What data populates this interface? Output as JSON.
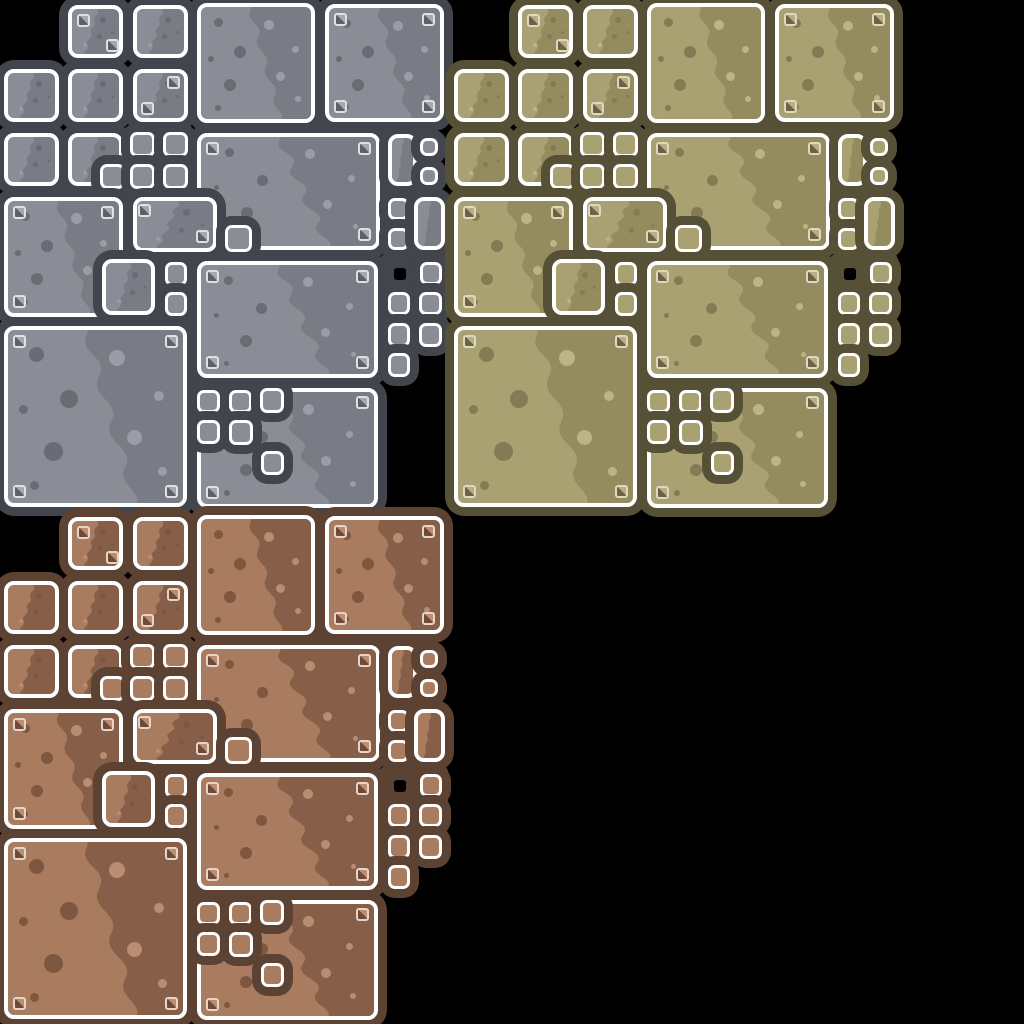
{
  "canvas": {
    "width": 1024,
    "height": 1024,
    "background": "#000000"
  },
  "sheet": {
    "description": "stone panel spritesheet, three color themes, identical tile layout per theme",
    "groups": [
      {
        "id": "gray",
        "label": "gray-stone-panels",
        "offset": {
          "x": 0,
          "y": 0
        },
        "colors": {
          "backing": "#43454d",
          "base": "#8b8d96",
          "shade": "#7a7c85",
          "dot_dark": "#6a6c75",
          "dot_light": "#9a9da6",
          "border": "#ffffff",
          "rivet_border": "#dfe0e3",
          "rivet_dark": "#5e6068",
          "rivet_light": "#a5a8b0"
        }
      },
      {
        "id": "olive",
        "label": "olive-stone-panels",
        "offset": {
          "x": 450,
          "y": 0
        },
        "colors": {
          "backing": "#565136",
          "base": "#aaa173",
          "shade": "#948b5e",
          "dot_dark": "#847b54",
          "dot_light": "#bcb388",
          "border": "#ffffff",
          "rivet_border": "#ded8c3",
          "rivet_dark": "#6c6343",
          "rivet_light": "#b7ae85"
        }
      },
      {
        "id": "brown",
        "label": "brown-stone-panels",
        "offset": {
          "x": 0,
          "y": 512
        },
        "colors": {
          "backing": "#5c4233",
          "base": "#a97b5f",
          "shade": "#875f49",
          "dot_dark": "#7d573f",
          "dot_light": "#b98d70",
          "border": "#ffffff",
          "rivet_border": "#e3d5ca",
          "rivet_dark": "#6f4a37",
          "rivet_light": "#bb8e71"
        }
      }
    ],
    "ring_width": 9,
    "blob_path": "M103,-3 L103,103 L72,103 C80,94 61,90 67,79 C73,68 53,65 59,53 C65,41 46,39 52,27 C58,15 40,14 45,3 C46,0 45,-2 44,-3 Z",
    "dots_large": [
      {
        "x": 0.16,
        "y": 0.14,
        "s": 0.085,
        "tone": "dark"
      },
      {
        "x": 0.35,
        "y": 0.4,
        "s": 0.105,
        "tone": "dark"
      },
      {
        "x": 0.09,
        "y": 0.46,
        "s": 0.05,
        "tone": "dark"
      },
      {
        "x": 0.26,
        "y": 0.7,
        "s": 0.11,
        "tone": "dark"
      },
      {
        "x": 0.15,
        "y": 0.9,
        "s": 0.05,
        "tone": "dark"
      },
      {
        "x": 0.62,
        "y": 0.16,
        "s": 0.095,
        "tone": "light"
      },
      {
        "x": 0.86,
        "y": 0.38,
        "s": 0.06,
        "tone": "light"
      },
      {
        "x": 0.72,
        "y": 0.62,
        "s": 0.085,
        "tone": "light"
      },
      {
        "x": 0.88,
        "y": 0.82,
        "s": 0.05,
        "tone": "light"
      }
    ],
    "dots_small": [
      {
        "x": 0.35,
        "y": 0.24,
        "s": 0.14,
        "tone": "dark"
      },
      {
        "x": 0.14,
        "y": 0.52,
        "s": 0.07,
        "tone": "dark"
      },
      {
        "x": 0.42,
        "y": 0.62,
        "s": 0.11,
        "tone": "dark"
      },
      {
        "x": 0.72,
        "y": 0.8,
        "s": 0.08,
        "tone": "light"
      }
    ],
    "tiles": [
      {
        "t": "p",
        "x": 68,
        "y": 5,
        "w": 55,
        "h": 53,
        "riv": [
          [
            9,
            9
          ],
          [
            38,
            34
          ]
        ]
      },
      {
        "t": "p",
        "x": 133,
        "y": 5,
        "w": 55,
        "h": 53
      },
      {
        "t": "p",
        "x": 197,
        "y": 3,
        "w": 118,
        "h": 120
      },
      {
        "t": "p",
        "x": 325,
        "y": 4,
        "w": 119,
        "h": 118,
        "riv": [
          [
            9,
            9
          ],
          [
            97,
            9
          ],
          [
            9,
            96
          ],
          [
            97,
            96
          ]
        ]
      },
      {
        "t": "p",
        "x": 4,
        "y": 69,
        "w": 55,
        "h": 53
      },
      {
        "t": "p",
        "x": 68,
        "y": 69,
        "w": 55,
        "h": 53
      },
      {
        "t": "p",
        "x": 133,
        "y": 69,
        "w": 55,
        "h": 53,
        "riv": [
          [
            34,
            7
          ],
          [
            8,
            33
          ]
        ]
      },
      {
        "t": "p",
        "x": 4,
        "y": 133,
        "w": 55,
        "h": 53
      },
      {
        "t": "p",
        "x": 68,
        "y": 133,
        "w": 55,
        "h": 53
      },
      {
        "t": "s",
        "x": 130,
        "y": 132,
        "w": 25,
        "h": 25
      },
      {
        "t": "s",
        "x": 163,
        "y": 132,
        "w": 25,
        "h": 25
      },
      {
        "t": "p",
        "x": 197,
        "y": 133,
        "w": 183,
        "h": 117,
        "riv": [
          [
            9,
            9
          ],
          [
            161,
            9
          ],
          [
            9,
            95
          ],
          [
            161,
            95
          ]
        ]
      },
      {
        "t": "p",
        "x": 388,
        "y": 134,
        "w": 29,
        "h": 52
      },
      {
        "t": "s",
        "x": 420,
        "y": 138,
        "w": 18,
        "h": 18
      },
      {
        "t": "s",
        "x": 420,
        "y": 167,
        "w": 18,
        "h": 18
      },
      {
        "t": "s",
        "x": 100,
        "y": 164,
        "w": 25,
        "h": 25
      },
      {
        "t": "s",
        "x": 130,
        "y": 164,
        "w": 25,
        "h": 25
      },
      {
        "t": "s",
        "x": 163,
        "y": 164,
        "w": 25,
        "h": 25
      },
      {
        "t": "p",
        "x": 4,
        "y": 197,
        "w": 119,
        "h": 120,
        "riv": [
          [
            9,
            9
          ],
          [
            97,
            9
          ],
          [
            9,
            98
          ],
          [
            97,
            98
          ]
        ]
      },
      {
        "t": "p",
        "x": 133,
        "y": 197,
        "w": 84,
        "h": 55,
        "riv": [
          [
            5,
            7
          ],
          [
            63,
            33
          ]
        ]
      },
      {
        "t": "s",
        "x": 225,
        "y": 225,
        "w": 27,
        "h": 27
      },
      {
        "t": "s",
        "x": 388,
        "y": 198,
        "w": 21,
        "h": 22
      },
      {
        "t": "s",
        "x": 388,
        "y": 228,
        "w": 21,
        "h": 22
      },
      {
        "t": "p",
        "x": 414,
        "y": 197,
        "w": 31,
        "h": 53
      },
      {
        "t": "p",
        "x": 102,
        "y": 259,
        "w": 53,
        "h": 56
      },
      {
        "t": "s",
        "x": 165,
        "y": 262,
        "w": 22,
        "h": 24
      },
      {
        "t": "s",
        "x": 165,
        "y": 292,
        "w": 22,
        "h": 24
      },
      {
        "t": "p",
        "x": 197,
        "y": 261,
        "w": 181,
        "h": 117,
        "riv": [
          [
            9,
            9
          ],
          [
            159,
            9
          ],
          [
            9,
            95
          ],
          [
            159,
            95
          ]
        ]
      },
      {
        "t": "s",
        "x": 420,
        "y": 262,
        "w": 22,
        "h": 23
      },
      {
        "t": "s",
        "x": 388,
        "y": 292,
        "w": 22,
        "h": 23
      },
      {
        "t": "s",
        "x": 419,
        "y": 292,
        "w": 23,
        "h": 23
      },
      {
        "t": "s",
        "x": 388,
        "y": 323,
        "w": 22,
        "h": 24
      },
      {
        "t": "s",
        "x": 419,
        "y": 323,
        "w": 23,
        "h": 24
      },
      {
        "t": "s",
        "x": 388,
        "y": 353,
        "w": 22,
        "h": 24
      },
      {
        "t": "p",
        "x": 4,
        "y": 326,
        "w": 183,
        "h": 181,
        "riv": [
          [
            9,
            9
          ],
          [
            161,
            9
          ],
          [
            9,
            159
          ],
          [
            161,
            159
          ]
        ]
      },
      {
        "t": "p",
        "x": 197,
        "y": 388,
        "w": 181,
        "h": 120,
        "riv": [
          [
            159,
            8
          ],
          [
            9,
            98
          ]
        ]
      },
      {
        "t": "s",
        "x": 197,
        "y": 390,
        "w": 23,
        "h": 23
      },
      {
        "t": "s",
        "x": 229,
        "y": 390,
        "w": 23,
        "h": 23
      },
      {
        "t": "s",
        "x": 260,
        "y": 388,
        "w": 24,
        "h": 25
      },
      {
        "t": "s",
        "x": 197,
        "y": 420,
        "w": 23,
        "h": 24
      },
      {
        "t": "s",
        "x": 229,
        "y": 420,
        "w": 24,
        "h": 25
      },
      {
        "t": "s",
        "x": 261,
        "y": 451,
        "w": 23,
        "h": 24
      }
    ],
    "patch": {
      "x": 380,
      "y": 254,
      "w": 68,
      "h": 40
    },
    "hole": {
      "x": 394,
      "y": 268,
      "w": 12,
      "h": 12
    }
  }
}
